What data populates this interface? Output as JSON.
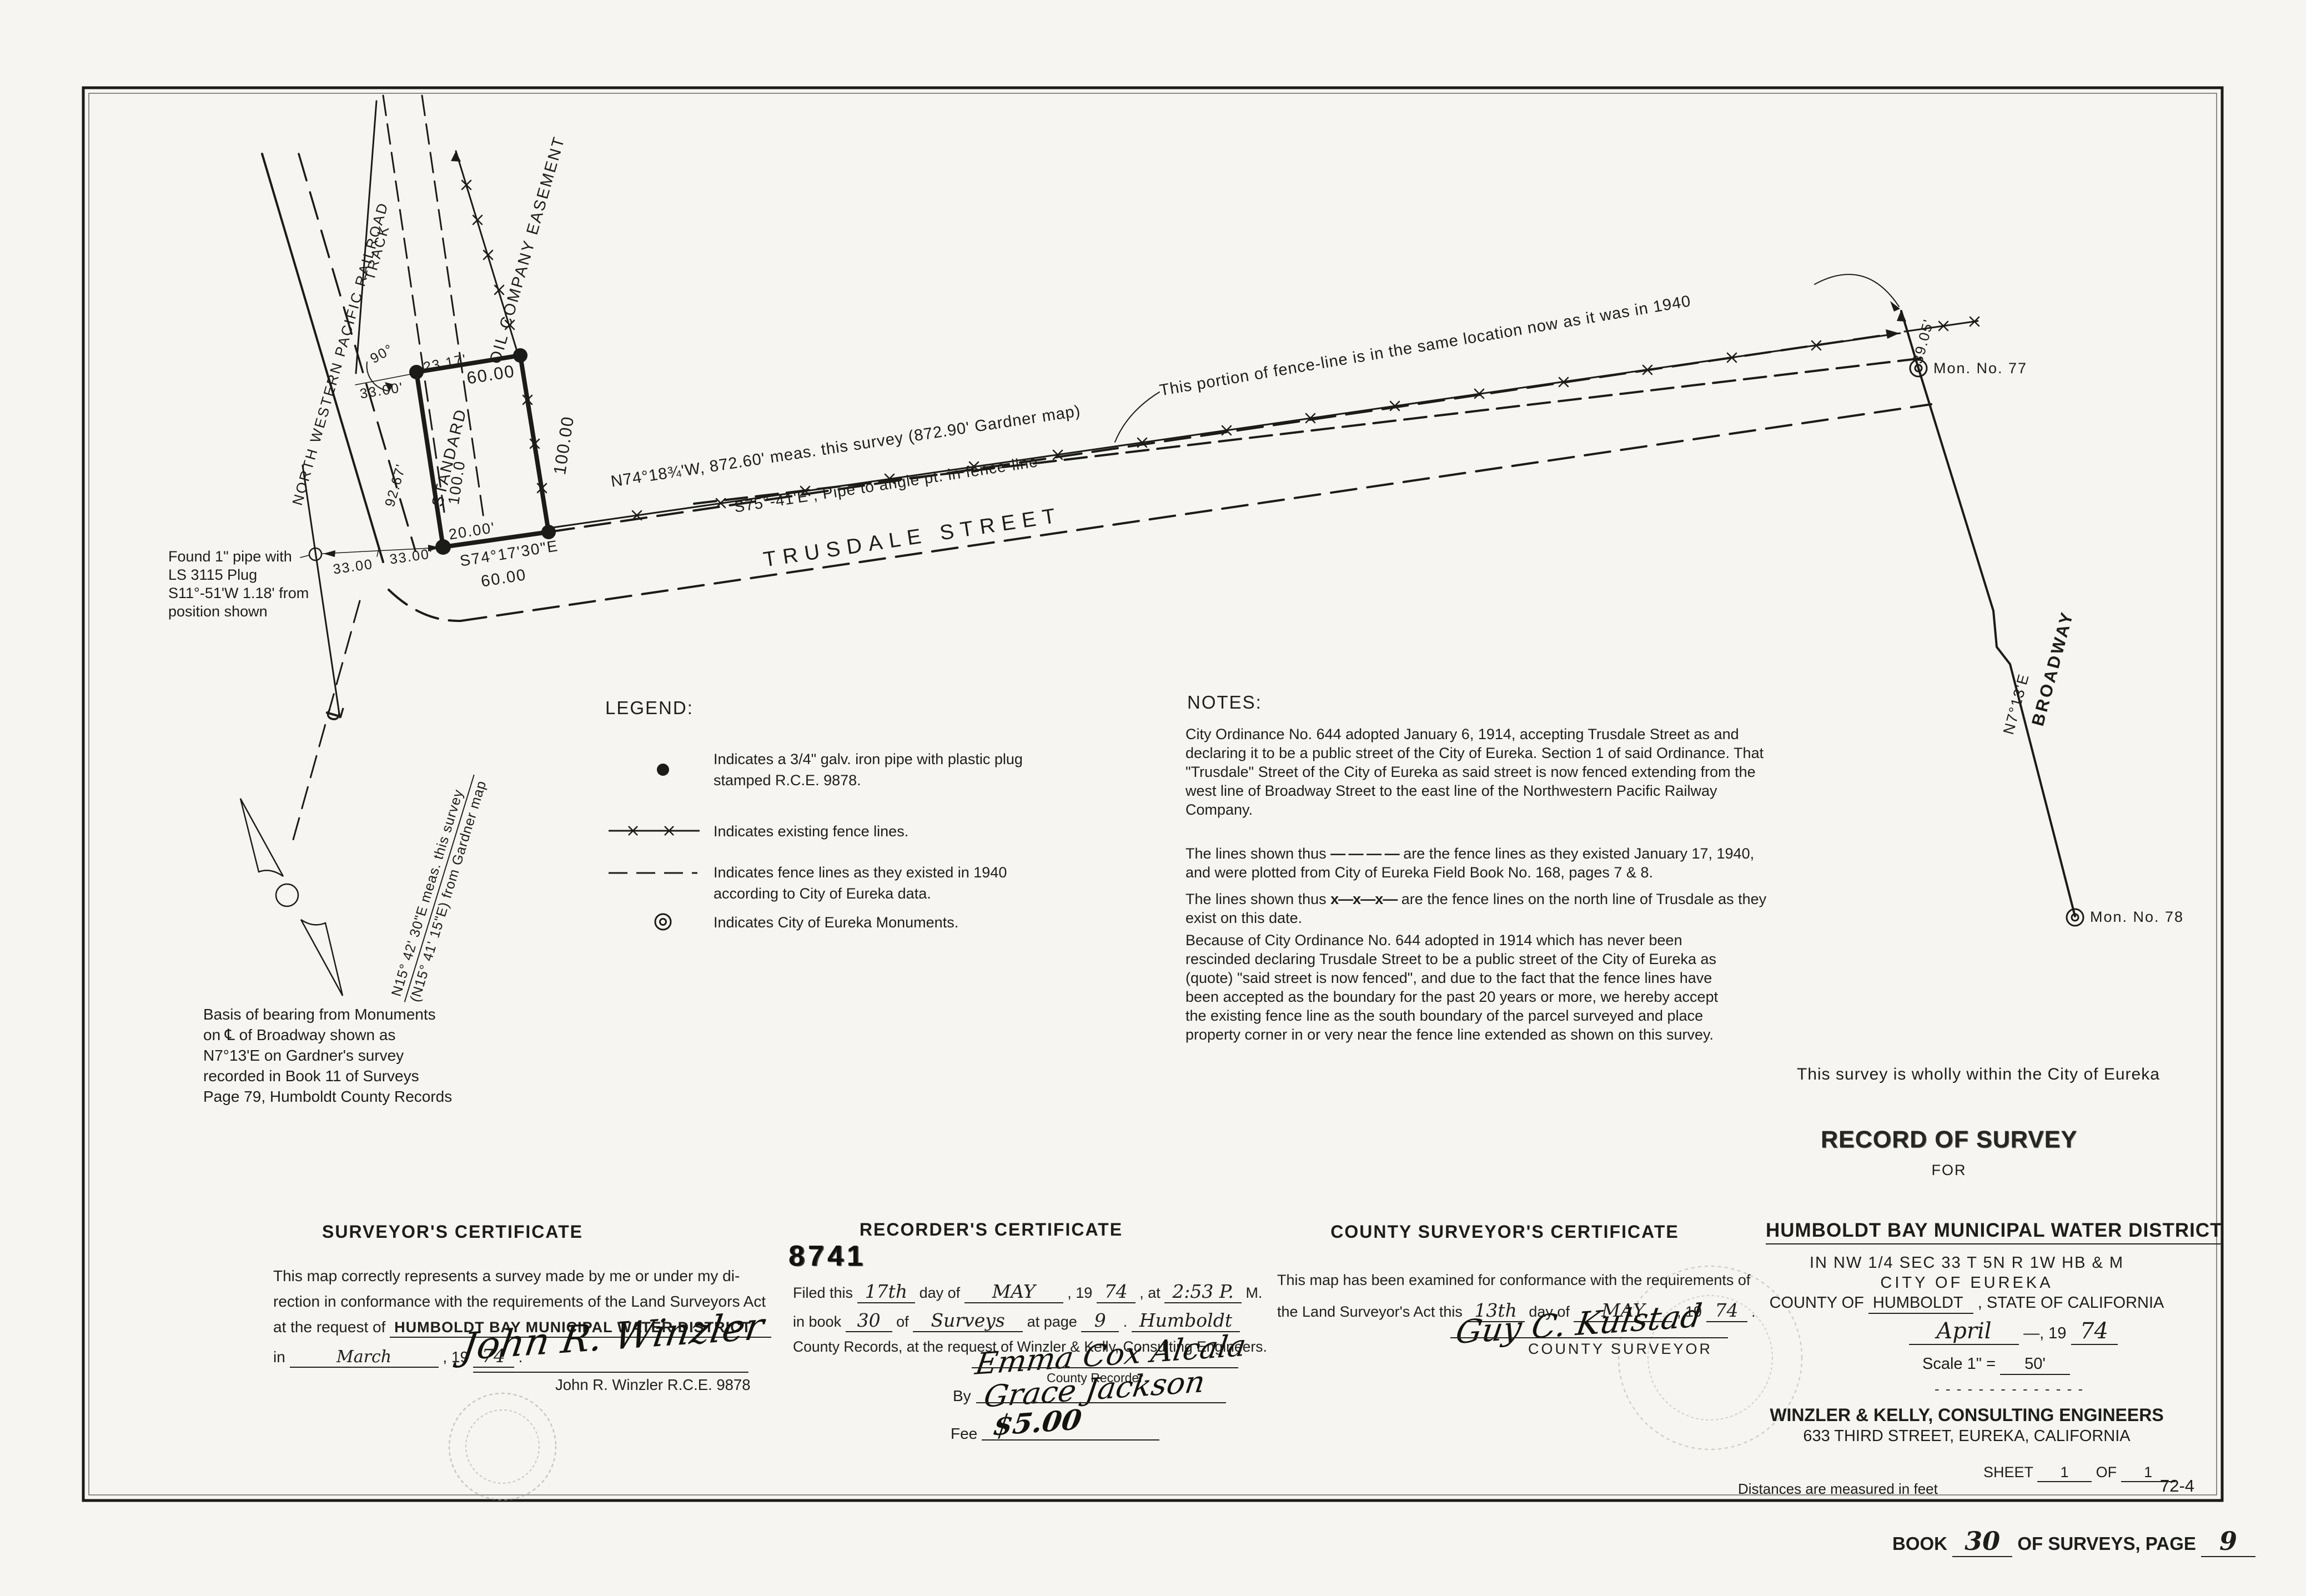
{
  "map": {
    "railroad": "NORTH WESTERN PACIFIC RAILROAD",
    "track": "TRACK",
    "standard": "STANDARD",
    "oil_easement": "OIL COMPANY EASEMENT",
    "street": "TRUSDALE STREET",
    "broadway": "BROADWAY",
    "broadway_bearing": "N7°13'E",
    "centerline": "℄",
    "mon77": "Mon. No. 77",
    "mon78": "Mon. No. 78",
    "fence_note": "This portion of fence-line is in the same location now as it was in 1940",
    "street_bearing1": "N74°18¾'W,  872.60' meas. this survey  (872.90' Gardner map)",
    "street_bearing2": "S75°-41'E , Pipe to angle pt. in fence-line",
    "rr_bearing1": "N15° 42' 30\"E meas. this survey",
    "rr_bearing2": "(N15° 41' 15\"E) from Gardner map",
    "wholly": "This survey is wholly within the City of Eureka",
    "dims": {
      "d23": "23.17'",
      "d60t": "60.00",
      "d100r": "100.00",
      "d100l": "100.0",
      "d20": "20.00'",
      "s74": "S74°17'30\"E",
      "d60b": "60.00",
      "d33a": "33.00'",
      "d33b": "33.00",
      "d33c": "33.00'",
      "d90": "90°",
      "d92": "92.67'",
      "d39": "39.05'"
    },
    "found_pipe": {
      "l1": "Found 1\" pipe with",
      "l2": "LS 3115 Plug",
      "l3": "S11°-51'W  1.18' from",
      "l4": "position shown"
    },
    "basis": {
      "l1": "Basis of bearing from Monuments",
      "l2": "on ℄ of Broadway shown as",
      "l3": "N7°13'E on Gardner's survey",
      "l4": "recorded in Book 11 of Surveys",
      "l5": "Page 79, Humboldt County Records"
    }
  },
  "legend": {
    "title": "LEGEND:",
    "i1l1": "Indicates a 3/4\" galv. iron pipe with plastic plug",
    "i1l2": "stamped  R.C.E. 9878.",
    "i2": "Indicates existing fence lines.",
    "i3l1": "Indicates fence lines as they existed in 1940",
    "i3l2": "according to City of Eureka data.",
    "i4": "Indicates  City of Eureka  Monuments."
  },
  "notes": {
    "title": "NOTES:",
    "p1": "City Ordinance No. 644 adopted January 6, 1914, accepting Trusdale Street as and declaring it to be a public street of the City of Eureka.  Section 1 of said Ordinance.  That \"Trusdale\" Street of the City of Eureka as said street is now fenced extending from the west line of Broadway Street to the east line of the Northwestern Pacific Railway Company.",
    "p2pre": "The lines shown thus",
    "p2sym": "— — — —",
    "p2post": "are the fence lines as they existed January 17, 1940, and were plotted from City of Eureka Field Book No. 168, pages 7 & 8.",
    "p3pre": "The lines shown thus",
    "p3sym": "x—x—x—",
    "p3post": "are the fence lines on the north line of Trusdale as they exist on this date.",
    "p4": "Because of City Ordinance No. 644 adopted in 1914 which has never been rescinded declaring Trusdale Street to be a public street of the City of Eureka as (quote) \"said street is now fenced\", and due to the fact that the fence lines have been accepted as the boundary for the past 20 years or more, we hereby accept the existing fence line as the south boundary of the parcel surveyed and place property corner in or very near the fence line extended as shown on this survey."
  },
  "surveyor": {
    "title": "SURVEYOR'S CERTIFICATE",
    "l1": "This map correctly represents a survey made by me or under my di-",
    "l2": "rection in conformance with the requirements of the Land Surveyors Act",
    "l3pre": "at the request of",
    "l3name": "HUMBOLDT BAY MUNICIPAL WATER DISTRICT",
    "l4pre": "in",
    "l4month": "March",
    "l4mid": ", 19",
    "l4yr": "74",
    "l4end": ".",
    "sig": "John R. Winzler",
    "name": "John R. Winzler  R.C.E. 9878"
  },
  "recorder": {
    "title": "RECORDER'S CERTIFICATE",
    "stamp": "8741",
    "f1": "Filed this",
    "f2": "17th",
    "f3": "day of",
    "f4": "MAY",
    "f5": ", 19",
    "f6": "74",
    "f7": ", at",
    "f8": "2:53 P.",
    "f9": "M.",
    "g1": "in book",
    "g2": "30",
    "g3": "of",
    "g4": "Surveys",
    "g5": "at page",
    "g6": "9",
    "g7": ".",
    "g8": "Humboldt",
    "l3": "County Records, at the request of Winzler & Kelly, Consulting Engineers.",
    "sig1": "Emma Cox Alcala",
    "sig1_title": "County Recorder",
    "by": "By",
    "sig2": "Grace Jackson",
    "fee_label": "Fee",
    "fee": "$5.00"
  },
  "county": {
    "title": "COUNTY SURVEYOR'S CERTIFICATE",
    "l1": "This map has been examined for conformance with the requirements of",
    "l2pre": "the Land Surveyor's Act this",
    "l2a": "13th",
    "l2b": "day of",
    "l2c": "MAY",
    "l2d": ", 19",
    "l2e": "74",
    "l2f": ".",
    "sig": "Guy C. Kulstad",
    "sig_title": "COUNTY SURVEYOR"
  },
  "title_block": {
    "ros": "RECORD OF SURVEY",
    "for": "FOR",
    "client": "HUMBOLDT BAY MUNICIPAL WATER DISTRICT",
    "loc1": "IN  NW 1/4  SEC  33  T  5N  R  1W  HB & M",
    "loc2": "CITY OF EUREKA",
    "county_pre": "COUNTY OF",
    "county": "HUMBOLDT",
    "county_post": ", STATE OF CALIFORNIA",
    "month": "April",
    "date_mid": "—, 19",
    "year": "74",
    "scale_label": "Scale 1\" =",
    "scale_val": "50'",
    "sep": "- - - - - - - - - - - - - -",
    "firm1": "WINZLER & KELLY, CONSULTING ENGINEERS",
    "firm2": "633 THIRD STREET, EUREKA, CALIFORNIA",
    "sheet_label": "SHEET",
    "sheet_no": "1",
    "sheet_of": "OF",
    "sheet_total": "1"
  },
  "footer": {
    "distances": "Distances are measured in feet",
    "code": "72-4",
    "book_label": "BOOK",
    "book_no": "30",
    "mid": "OF SURVEYS, PAGE",
    "page_no": "9"
  }
}
